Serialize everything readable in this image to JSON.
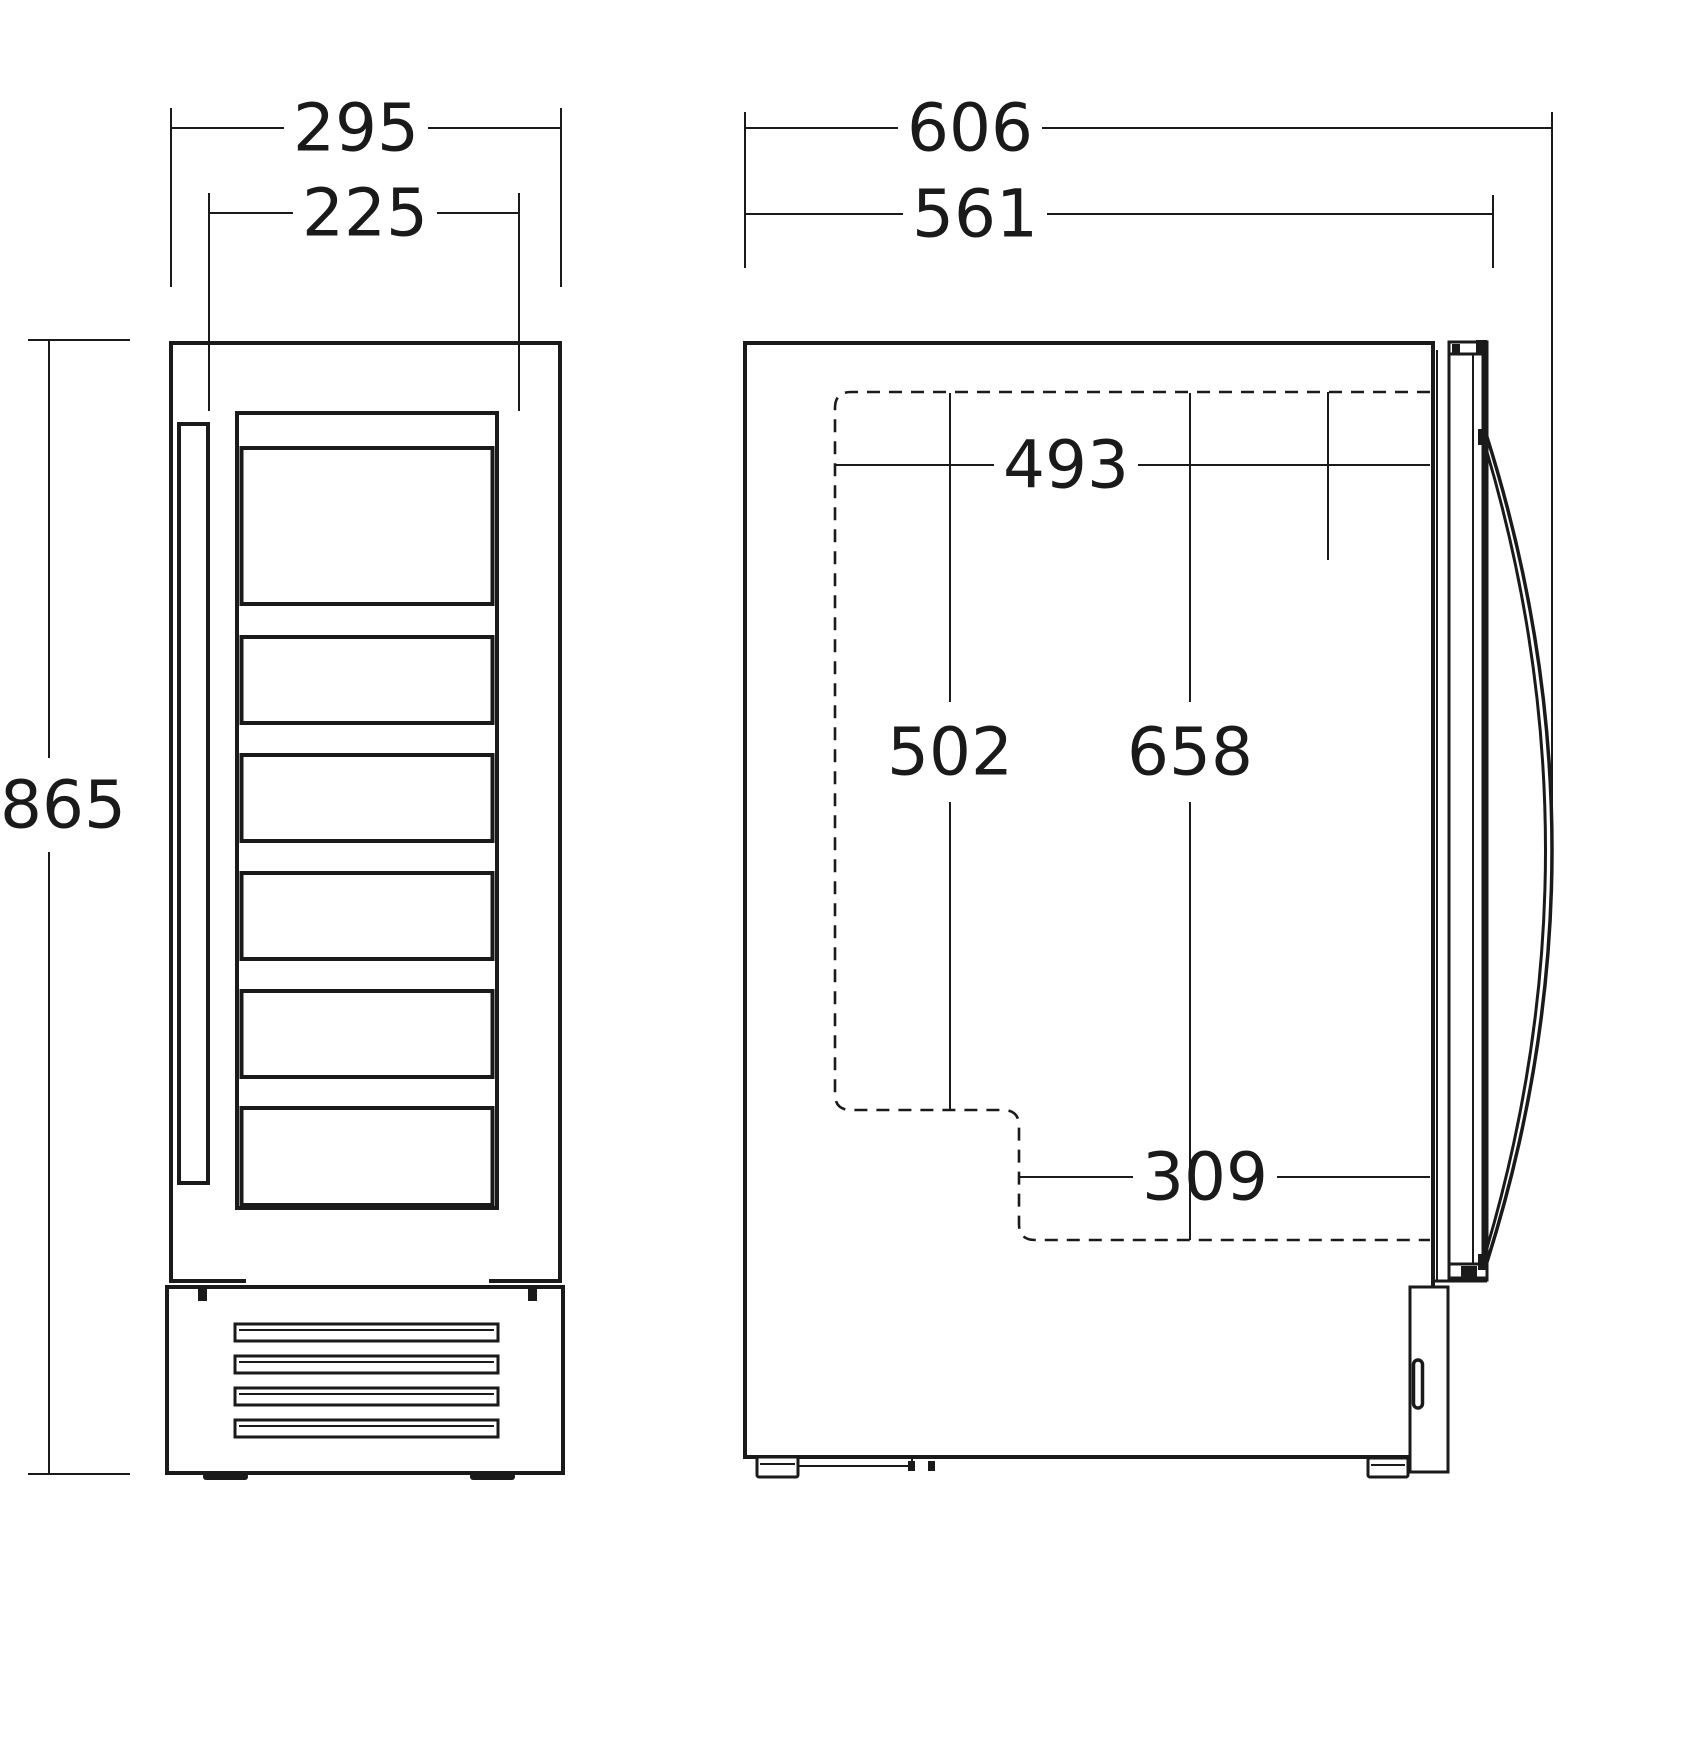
{
  "dimensions": {
    "front": {
      "width": "295",
      "door_width": "225",
      "height": "865"
    },
    "side": {
      "depth": "606",
      "body_depth": "561",
      "interior_width": "493",
      "interior_front_height": "502",
      "interior_rear_height": "658",
      "interior_lower_width": "309"
    }
  },
  "colors": {
    "line": "#1a1a1a",
    "background": "#ffffff"
  }
}
